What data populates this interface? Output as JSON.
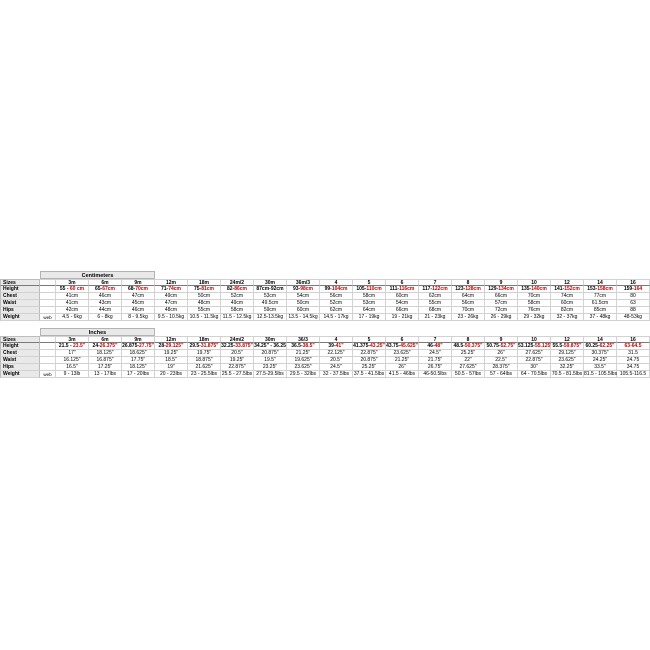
{
  "page": {
    "background": "#ffffff"
  },
  "colors": {
    "highlight_red": "#c00000",
    "marker_green": "#3a8a3a",
    "grid_line": "#d2d2d2",
    "label_fill": "#e9e9e9",
    "text": "#000000"
  },
  "tables": [
    {
      "title": "Centimeters",
      "row_labels": [
        "Sizes",
        "Height",
        "Chest",
        "Waist",
        "Hips",
        "Weight"
      ],
      "weight_note": "web",
      "sizes": [
        "3m",
        "6m",
        "9m",
        "12m",
        "18m",
        "24m/2",
        "30m",
        "36m/3",
        "4",
        "5",
        "6",
        "7",
        "8",
        "9",
        "10",
        "12",
        "14",
        "16"
      ],
      "height": [
        [
          "55 - ",
          "60 cm"
        ],
        [
          "65-",
          "67cm"
        ],
        [
          "68-",
          "70cm"
        ],
        [
          "71-",
          "74cm"
        ],
        [
          "75-",
          "81cm"
        ],
        [
          "82-",
          "86cm"
        ],
        [
          "87cm-92cm",
          ""
        ],
        [
          "93-",
          "98cm"
        ],
        [
          "99-",
          "104cm"
        ],
        [
          "105-",
          "110cm"
        ],
        [
          "111-",
          "116cm"
        ],
        [
          "117-",
          "122cm"
        ],
        [
          "123-",
          "128cm"
        ],
        [
          "129-",
          "134cm"
        ],
        [
          "135-",
          "140cm"
        ],
        [
          "141-",
          "152cm"
        ],
        [
          "153-",
          "158cm"
        ],
        [
          "159-",
          "164"
        ]
      ],
      "chest": [
        "41cm",
        "46cm",
        "47cm",
        "49cm",
        "50cm",
        "52cm",
        "53cm",
        "54cm",
        "56cm",
        "58cm",
        "60cm",
        "62cm",
        "64cm",
        "66cm",
        "70cm",
        "74cm",
        "77cm",
        "80"
      ],
      "waist": [
        "41cm",
        "43cm",
        "45cm",
        "47cm",
        "48cm",
        "49cm",
        "49.5cm",
        "50cm",
        "52cm",
        "53cm",
        "54cm",
        "55cm",
        "56cm",
        "57cm",
        "58cm",
        "60cm",
        "61.5cm",
        "63"
      ],
      "hips": [
        "42cm",
        "44cm",
        "46cm",
        "48cm",
        "55cm",
        "58cm",
        "59cm",
        "60cm",
        "62cm",
        "64cm",
        "66cm",
        "68cm",
        "70cm",
        "72cm",
        "76cm",
        "82cm",
        "85cm",
        "88"
      ],
      "weight": [
        "4.5 - 6kg",
        "6 - 8kg",
        "8 - 9.5kg",
        "9.5 - 10.5kg",
        "10.5 - 11.5kg",
        "11.5 - 12.5kg",
        "12.5-13.5kg",
        "13.5 - 14.5kg",
        "14.5 - 17kg",
        "17 - 19kg",
        "19 - 21kg",
        "21 - 23kg",
        "23 - 26kg",
        "26 - 29kg",
        "29 - 32kg",
        "32 - 37kg",
        "37 - 48kg",
        "48-53kg"
      ],
      "markers": [
        {
          "row": "sizes",
          "col": 8
        },
        {
          "row": "chest",
          "col": 17
        },
        {
          "row": "waist",
          "col": 17
        },
        {
          "row": "hips",
          "col": 17
        }
      ]
    },
    {
      "title": "Inches",
      "row_labels": [
        "Sizes",
        "Height",
        "Chest",
        "Waist",
        "Hips",
        "Weight"
      ],
      "weight_note": "web",
      "sizes": [
        "3m",
        "6m",
        "9m",
        "12m",
        "18m",
        "24m/2",
        "30m",
        "36/3",
        "4",
        "5",
        "6",
        "7",
        "8",
        "9",
        "10",
        "12",
        "14",
        "16"
      ],
      "height": [
        [
          "21.5 - ",
          "23.5\""
        ],
        [
          "24-",
          "26.375\""
        ],
        [
          "26.875-",
          "27.75\""
        ],
        [
          "28-",
          "29.125\""
        ],
        [
          "29.5-",
          "31.875\""
        ],
        [
          "32.25-",
          "33.875\""
        ],
        [
          "34.25\" - 36.25",
          ""
        ],
        [
          "36.5-",
          "38.5\""
        ],
        [
          "39-",
          "41\""
        ],
        [
          "41.375-",
          "43.25\""
        ],
        [
          "43.75-",
          "45.625\""
        ],
        [
          "46-",
          "48\""
        ],
        [
          "48.5-",
          "50.375\""
        ],
        [
          "50.75-",
          "52.75\""
        ],
        [
          "53.125-",
          "55.125\""
        ],
        [
          "55.5-",
          "59.875\""
        ],
        [
          "60.25-",
          "62.25\""
        ],
        [
          "",
          "63-64.5"
        ]
      ],
      "chest": [
        "17\"",
        "18.125\"",
        "18.625\"",
        "19.25\"",
        "19.75\"",
        "20.5\"",
        "20.875\"",
        "21.25\"",
        "22.125\"",
        "22.875\"",
        "23.625\"",
        "24.5\"",
        "25.25\"",
        "26\"",
        "27.625\"",
        "29.125\"",
        "30.375\"",
        "31.5"
      ],
      "waist": [
        "16.125\"",
        "16.875\"",
        "17.75\"",
        "18.5\"",
        "18.875\"",
        "19.25\"",
        "19.5\"",
        "19.625\"",
        "20.5\"",
        "20.875\"",
        "21.25\"",
        "21.75\"",
        "22\"",
        "22.5\"",
        "22.875\"",
        "23.625\"",
        "24.25\"",
        "24.75"
      ],
      "hips": [
        "16.5\"",
        "17.25\"",
        "18.125\"",
        "19\"",
        "21.625\"",
        "22.875\"",
        "23.25\"",
        "23.625\"",
        "24.5\"",
        "25.25\"",
        "26\"",
        "26.75\"",
        "27.625\"",
        "28.375\"",
        "30\"",
        "32.25\"",
        "33.5\"",
        "34.75"
      ],
      "weight": [
        "9 - 13lb",
        "13 - 17lbs",
        "17 - 20lbs",
        "20 - 23lbs",
        "23 - 25.5lbs",
        "25.5 - 27.5lbs",
        "27.5-29.5lbs",
        "29.5 - 32lbs",
        "32 - 37.5lbs",
        "37.5 - 41.5lbs",
        "41.5 - 46lbs",
        "46-50.5lbs",
        "50.5 - 57lbs",
        "57 - 64lbs",
        "64 - 70.5lbs",
        "70.5 - 81.5lbs",
        "81.5 - 105.5lbs",
        "105.5-116.5"
      ],
      "markers": [
        {
          "row": "sizes",
          "col": 8
        },
        {
          "row": "sizes",
          "col": 17
        },
        {
          "row": "hips",
          "col": 17
        }
      ]
    }
  ]
}
